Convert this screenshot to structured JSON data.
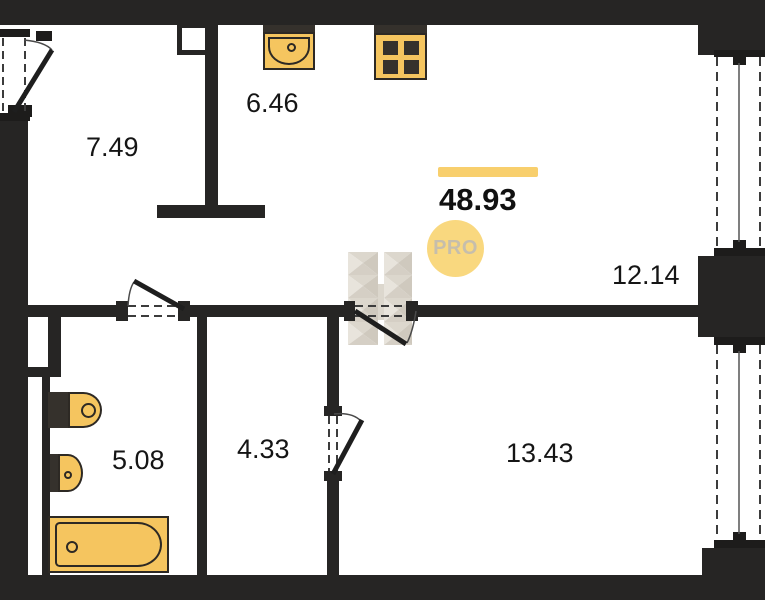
{
  "view": {
    "title": "apartment-floor-plan"
  },
  "total": {
    "value": "48.93",
    "accent_color": "#F8CF6D"
  },
  "badge": {
    "label": "PRO",
    "bg": "#F9D87F",
    "fg": "#C6BEAC"
  },
  "rooms": {
    "top_left": {
      "area": "7.49"
    },
    "kitchen": {
      "area": "6.46"
    },
    "living": {
      "area": "12.14"
    },
    "bathroom": {
      "area": "5.08"
    },
    "hallway": {
      "area": "4.33"
    },
    "bedroom": {
      "area": "13.43"
    }
  },
  "icons": {
    "kitchen_sink": "kitchen-sink-icon",
    "stove": "stove-burners-icon",
    "toilet": "toilet-icon",
    "washbasin": "washbasin-icon",
    "bathtub": "bathtub-icon",
    "watermark": "h-logo-watermark"
  },
  "colors": {
    "wall": "#262524",
    "fixture_fill": "#F5C55F",
    "fixture_dark": "#35312C",
    "fixture_outline": "#2D2924",
    "watermark": "#D9D3C9"
  }
}
